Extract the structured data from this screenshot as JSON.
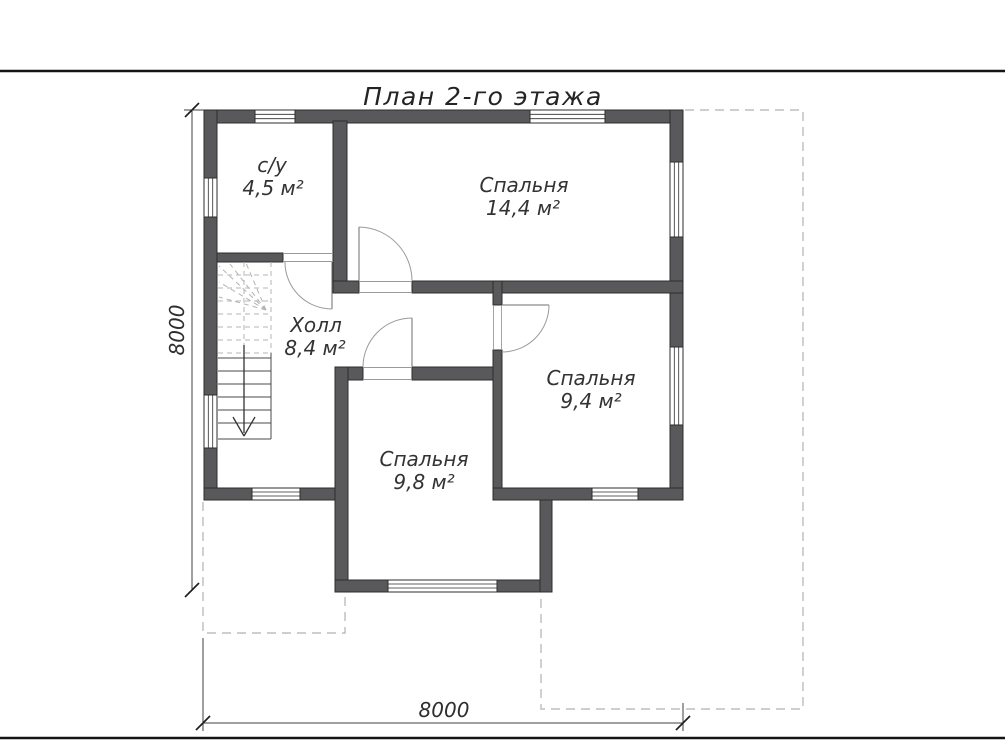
{
  "title": "План 2-го этажа",
  "rooms": {
    "bathroom": {
      "name": "с/у",
      "area": "4,5 м²"
    },
    "bedroom_large": {
      "name": "Спальня",
      "area": "14,4 м²"
    },
    "hall": {
      "name": "Холл",
      "area": "8,4 м²"
    },
    "bedroom_right": {
      "name": "Спальня",
      "area": "9,4 м²"
    },
    "bedroom_bottom": {
      "name": "Спальня",
      "area": "9,8 м²"
    }
  },
  "dimensions": {
    "bottom_width": "8000",
    "left_height": "8000"
  },
  "colors": {
    "wall": "#59595c",
    "roof_outline_dash": "#bdbdbd",
    "stair_dash": "#b4b4b4",
    "dimension_line": "#3f3f3f",
    "text": "#333333",
    "background": "#ffffff"
  }
}
